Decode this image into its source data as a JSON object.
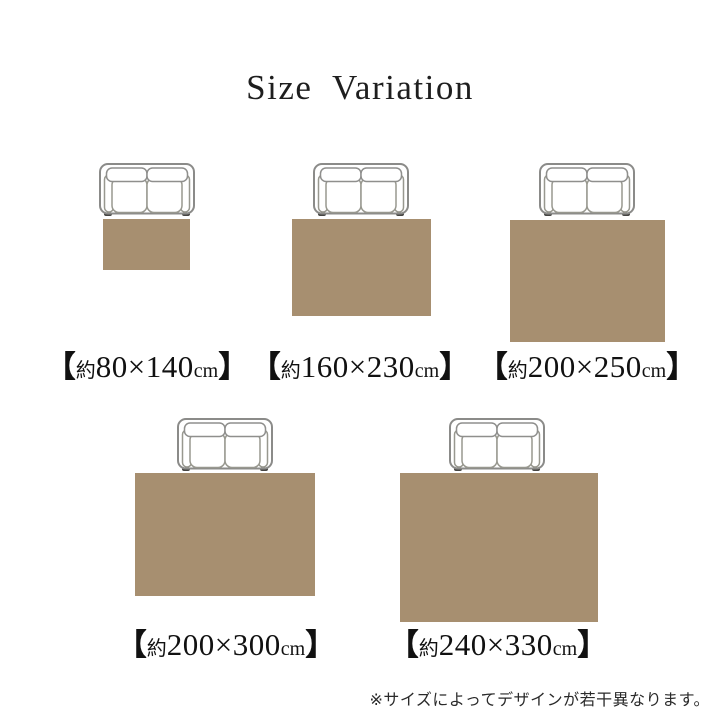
{
  "title": "Size Variation",
  "note": "※サイズによってデザインが若干異なります。",
  "colors": {
    "rug": "#a78f70",
    "sofa_outline": "#8b8b89",
    "sofa_foot": "#454442",
    "text": "#111111"
  },
  "brackets": {
    "open": "【",
    "close": "】"
  },
  "sizes": [
    {
      "prefix": "約",
      "dims": "80×140",
      "unit": "cm"
    },
    {
      "prefix": "約",
      "dims": "160×230",
      "unit": "cm"
    },
    {
      "prefix": "約",
      "dims": "200×250",
      "unit": "cm"
    },
    {
      "prefix": "約",
      "dims": "200×300",
      "unit": "cm"
    },
    {
      "prefix": "約",
      "dims": "240×330",
      "unit": "cm"
    }
  ]
}
